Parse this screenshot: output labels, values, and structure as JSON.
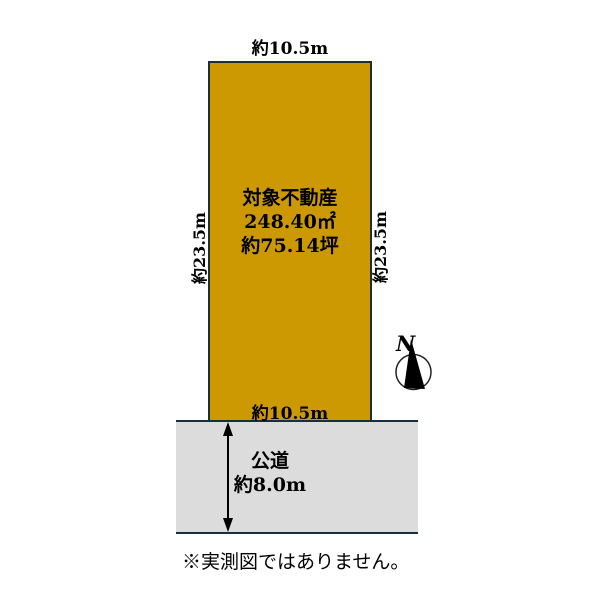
{
  "colors": {
    "plot_fill": "#CC9902",
    "outline": "#16313C",
    "road_fill": "#DCDCDC",
    "text": "#000000"
  },
  "plot": {
    "title": "対象不動産",
    "area_m2": "248.40㎡",
    "area_tsubo": "約75.14坪",
    "width_top": "約10.5m",
    "width_bottom": "約10.5m",
    "depth_left": "約23.5m",
    "depth_right": "約23.5m"
  },
  "road": {
    "name": "公道",
    "width": "約8.0m"
  },
  "compass": {
    "label": "N"
  },
  "note": "※実測図ではありません。"
}
